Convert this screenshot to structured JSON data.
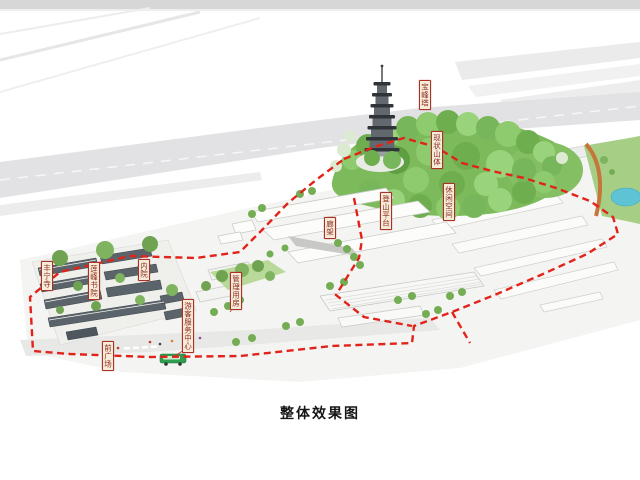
{
  "figure": {
    "caption": "整体效果图"
  },
  "annotations": {
    "pagoda": "宝峰塔",
    "existing_hill": "现状山体",
    "leisure_space": "休闲空间",
    "climbing_platform": "登山平台",
    "pergola": "廊架",
    "management_building": "管理用房",
    "visitor_center": "游客服务中心",
    "inner_courtyard": "内院",
    "lianfeng_academy": "莲峰书院",
    "fengning_temple": "丰宁寺",
    "front_plaza": "前广场"
  },
  "colors": {
    "boundary_red": "#e2231a",
    "label_background": "#f6ecd9",
    "label_border": "#a93226",
    "label_text": "#8e2a1f",
    "hill_green": "#7cba5c",
    "pond_blue": "#5fc3d6",
    "bus_green": "#2e9e4f",
    "caption_text": "#161616"
  }
}
